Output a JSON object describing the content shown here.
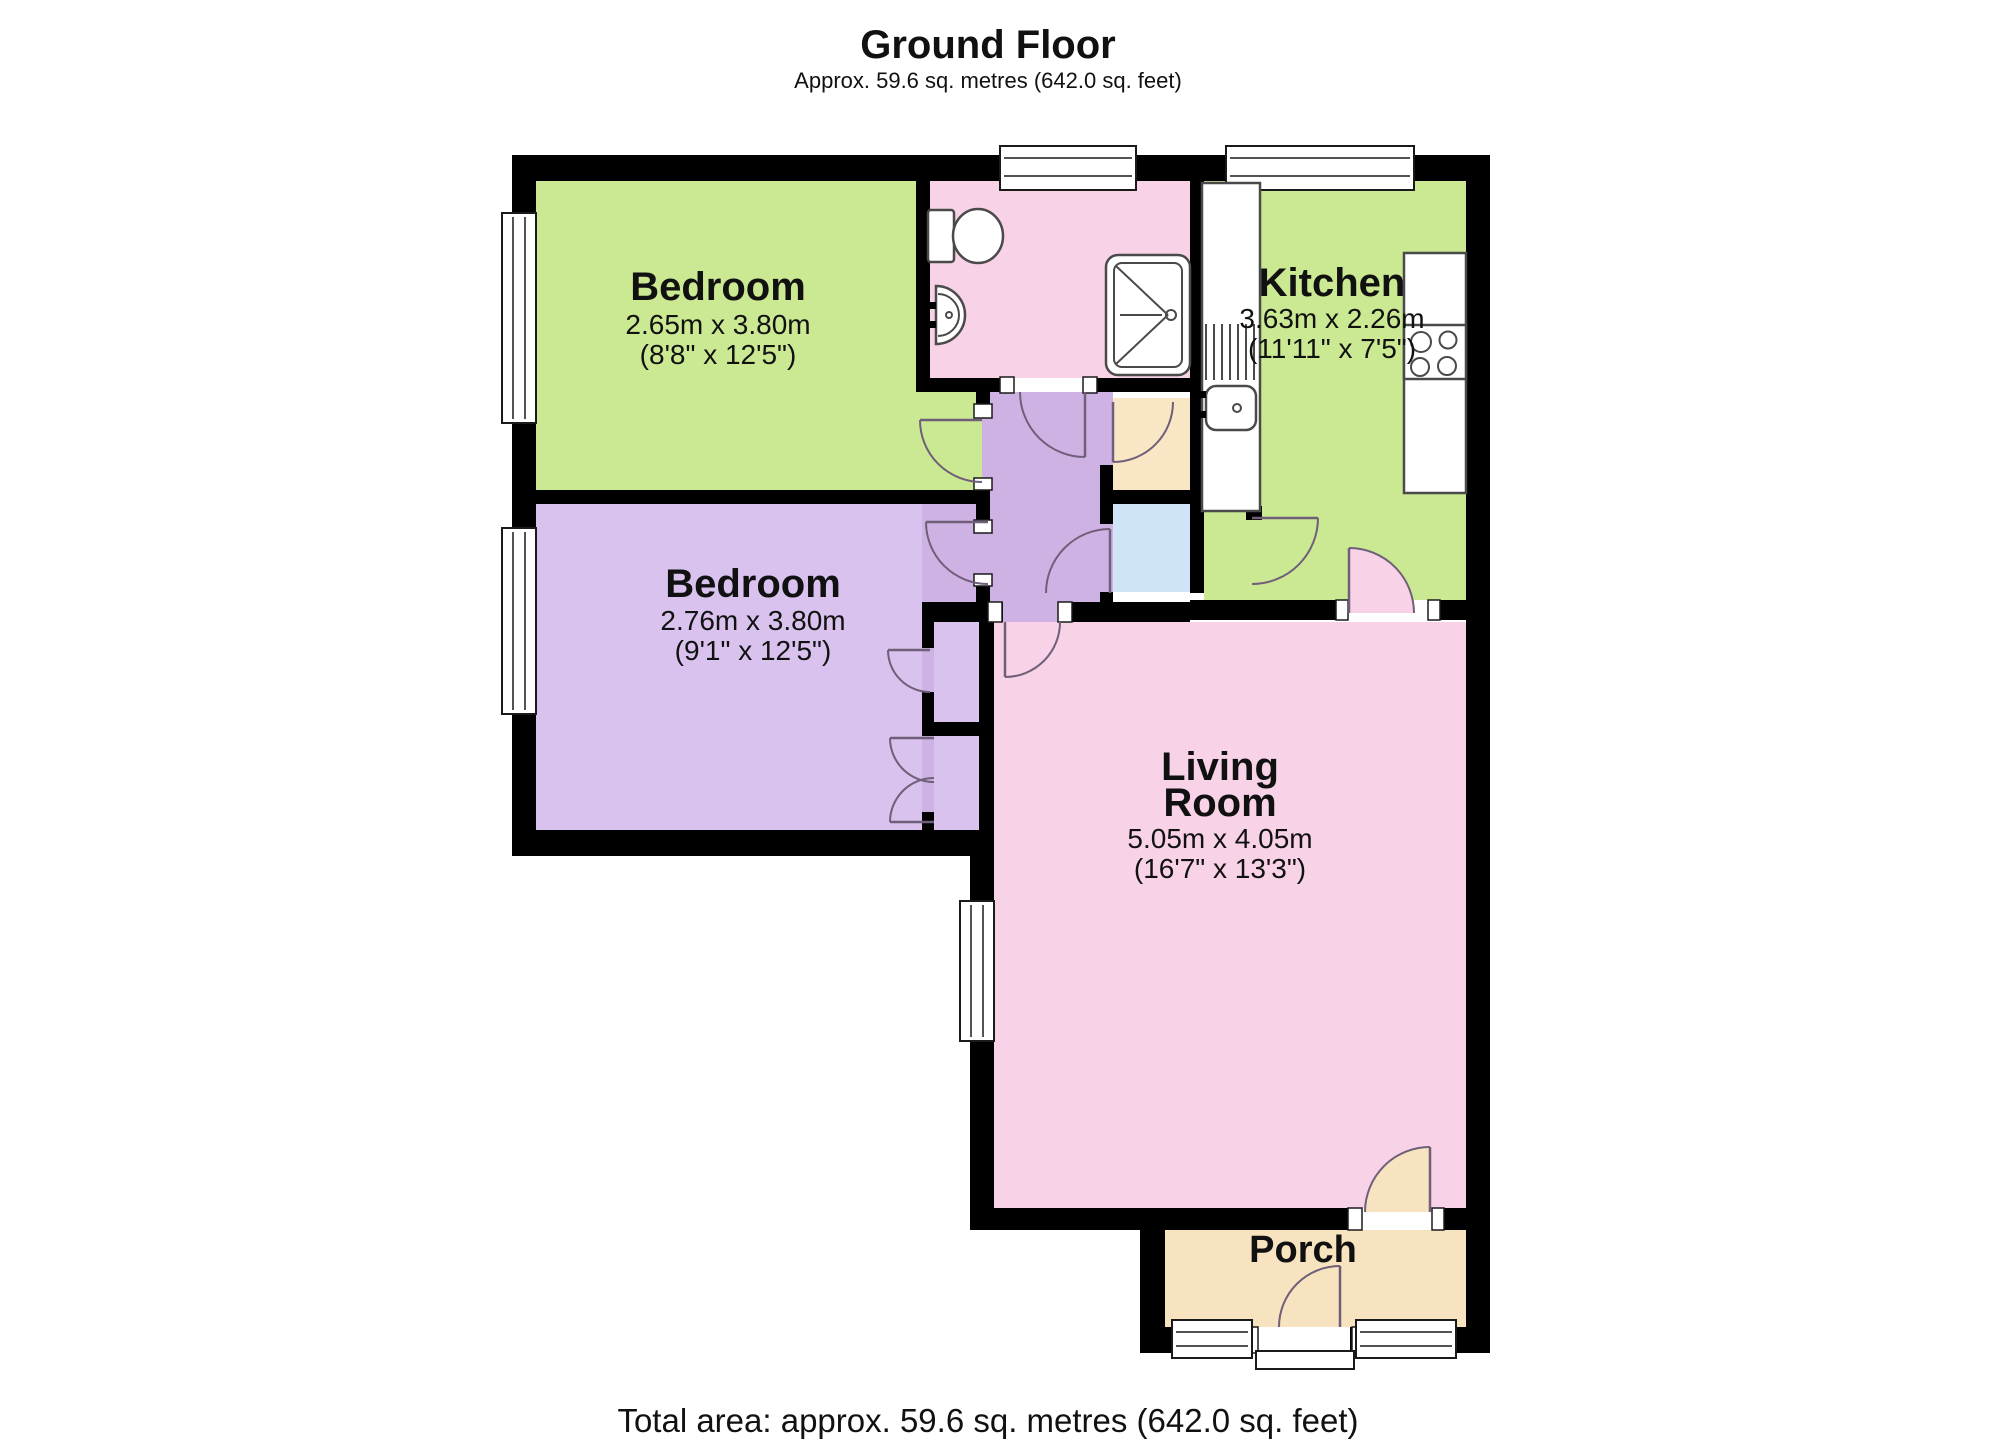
{
  "header": {
    "title": "Ground Floor",
    "subtitle": "Approx. 59.6 sq. metres (642.0 sq. feet)"
  },
  "footer": {
    "total_area": "Total area: approx. 59.6 sq. metres (642.0 sq. feet)"
  },
  "rooms": {
    "bedroom1": {
      "name": "Bedroom",
      "dims_m": "2.65m x 3.80m",
      "dims_ft": "(8'8\" x 12'5\")"
    },
    "bedroom2": {
      "name": "Bedroom",
      "dims_m": "2.76m x 3.80m",
      "dims_ft": "(9'1\" x 12'5\")"
    },
    "kitchen": {
      "name": "Kitchen",
      "dims_m": "3.63m x 2.26m",
      "dims_ft": "(11'11\" x 7'5\")"
    },
    "living": {
      "name_line1": "Living",
      "name_line2": "Room",
      "dims_m": "5.05m x 4.05m",
      "dims_ft": "(16'7\" x 13'3\")"
    },
    "porch": {
      "name": "Porch"
    }
  },
  "colors": {
    "wall": "#000000",
    "room_green": "#cbe992",
    "room_pink": "#f8d2e7",
    "hallway_lilac": "#cfb2e4",
    "bedroom_lilac": "#d9c2ee",
    "cupboard_cream": "#f9e6c5",
    "cupboard_blue": "#cfe4f6",
    "porch_cream": "#f7e3c0",
    "door_arc": "#6f5f78"
  }
}
